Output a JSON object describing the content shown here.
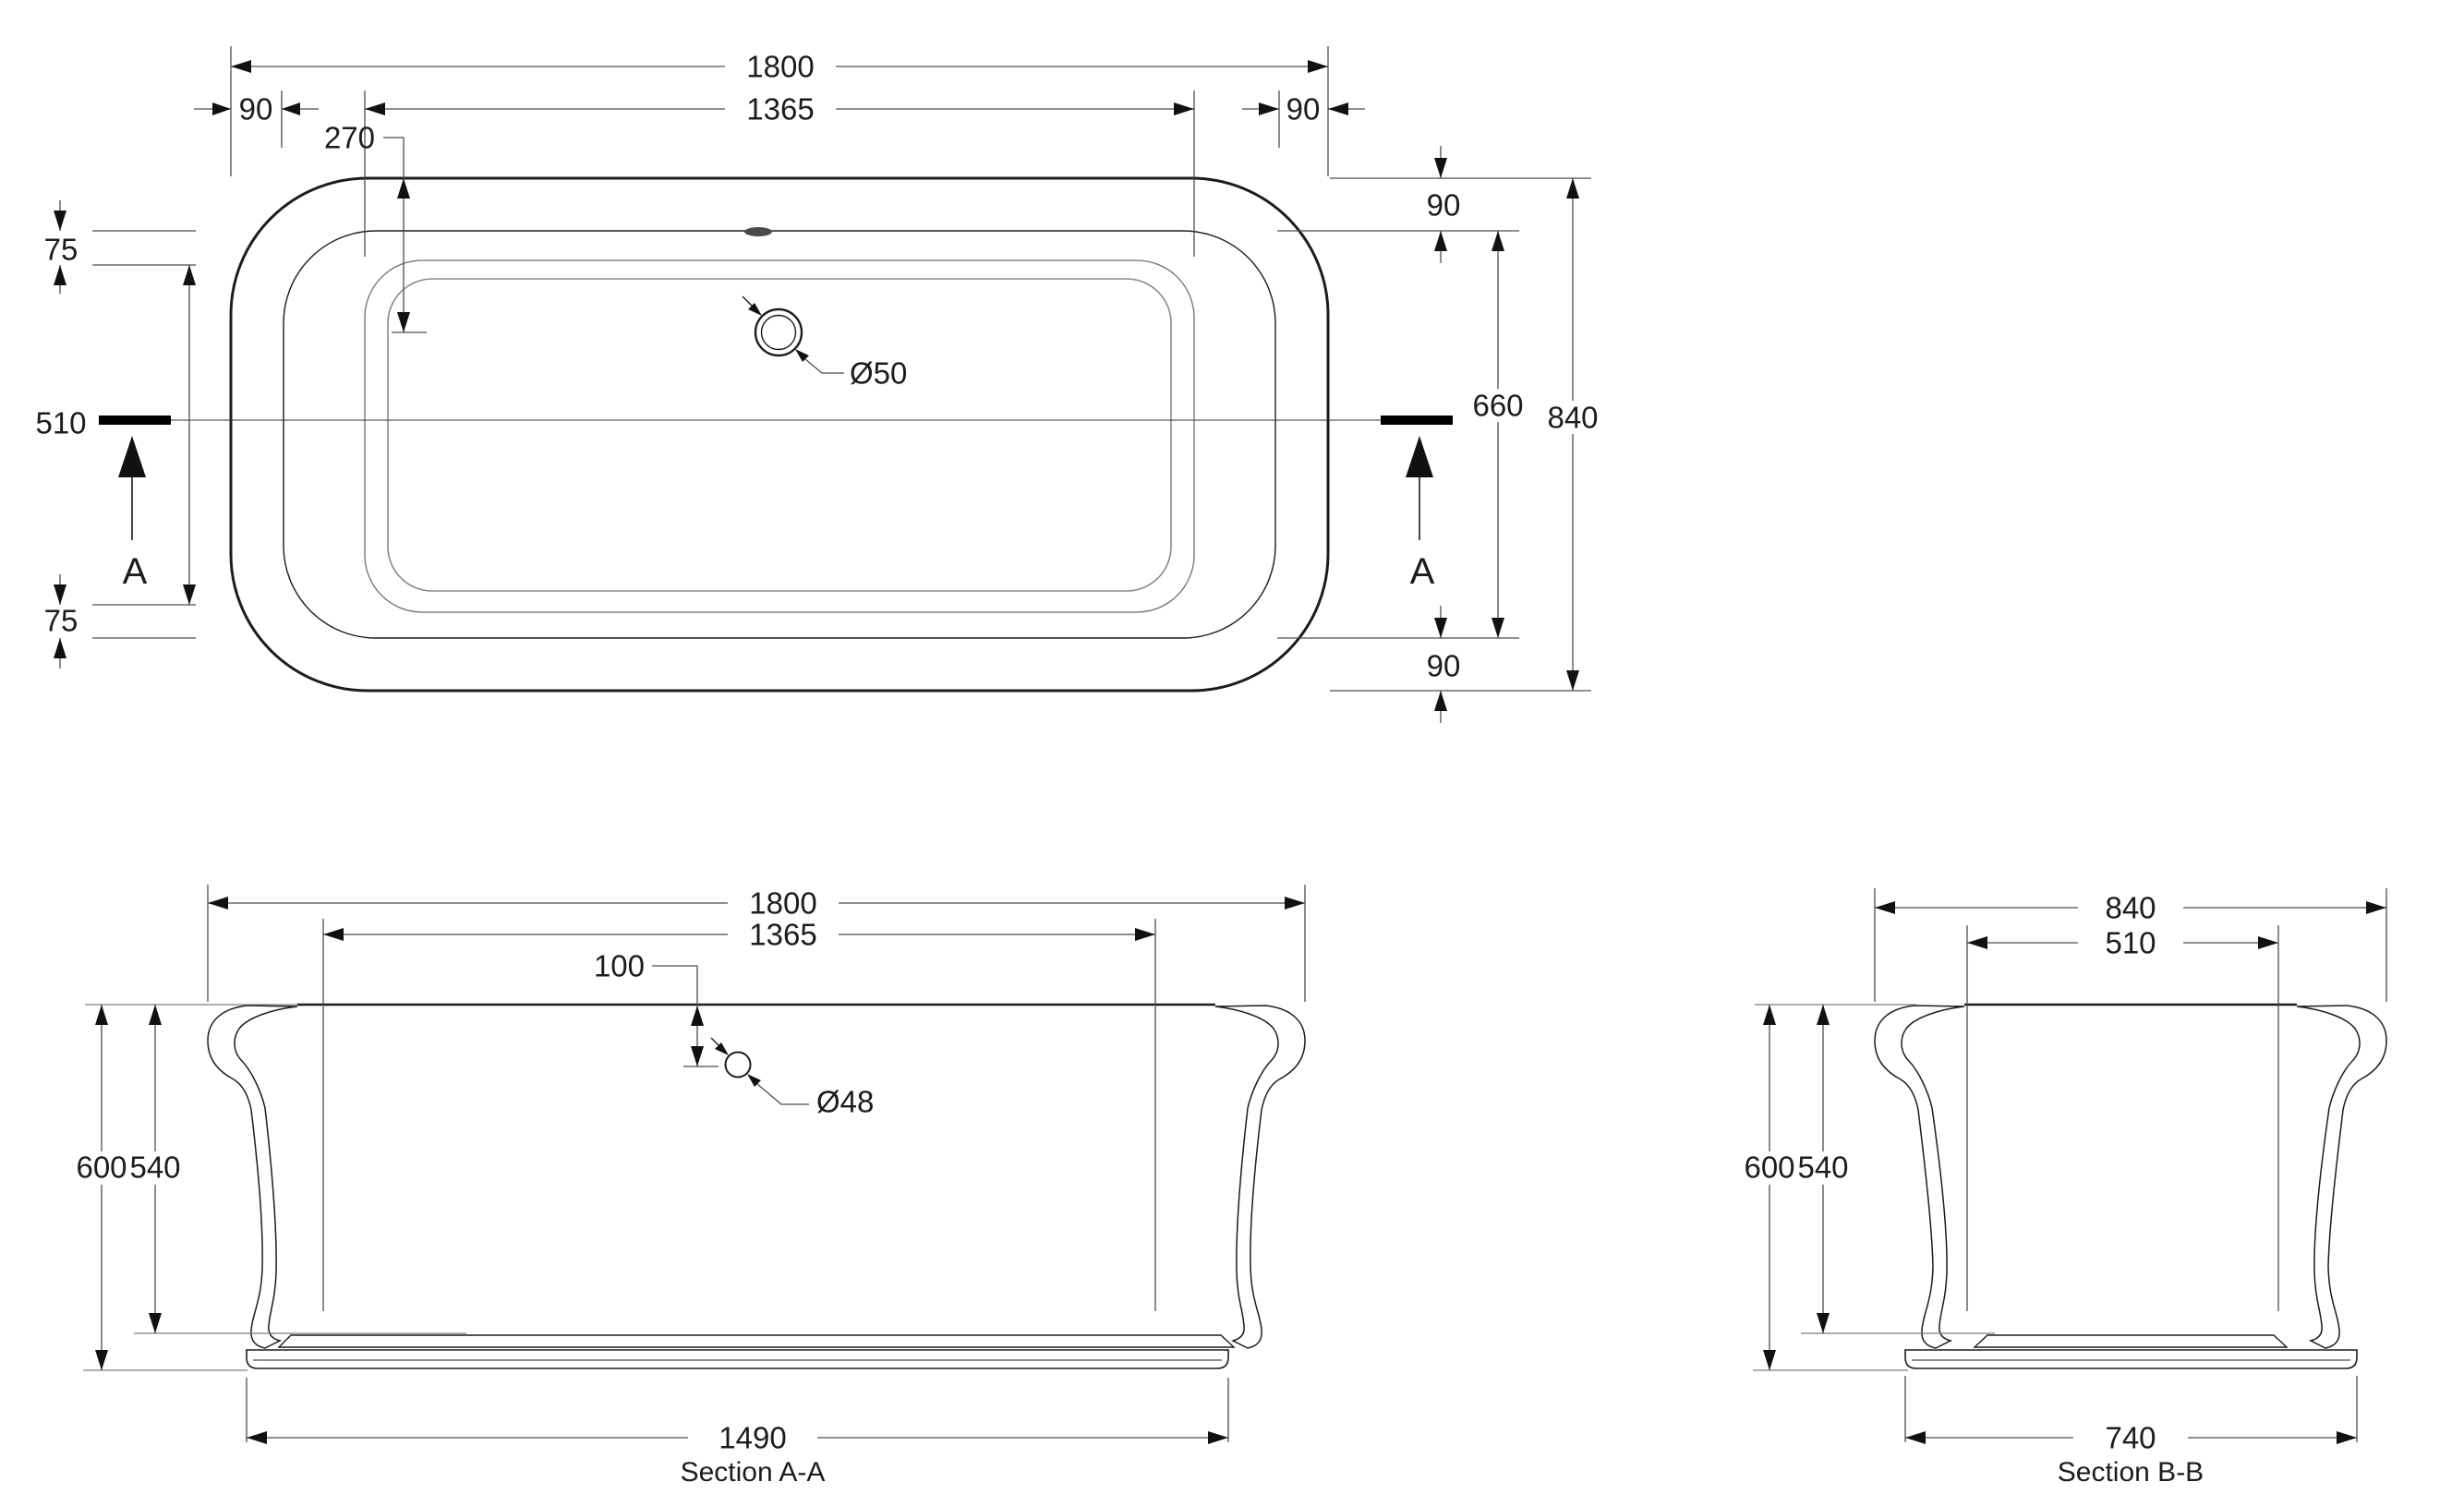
{
  "drawing": {
    "background": "#ffffff",
    "line_color": "#1c1c1c",
    "dim_color": "#4d4d4d"
  },
  "plan": {
    "dim_overall_length": "1800",
    "dim_rim_left": "90",
    "dim_inner_length": "1365",
    "dim_rim_right": "90",
    "dim_drain_offset": "270",
    "dim_rim_top_width": "75",
    "dim_section_width": "510",
    "dim_rim_bottom_width": "75",
    "dim_rim_top": "90",
    "dim_inner_width": "660",
    "dim_overall_width": "840",
    "dim_rim_bottom": "90",
    "dim_drain_diameter": "Ø50",
    "section_marker_left": "A",
    "section_marker_right": "A"
  },
  "section_aa": {
    "title": "Section A-A",
    "dim_overall_length": "1800",
    "dim_inner_length": "1365",
    "dim_drain_depth": "100",
    "dim_drain_diameter": "Ø48",
    "dim_overall_height": "600",
    "dim_inner_depth": "540",
    "dim_base_length": "1490"
  },
  "section_bb": {
    "title": "Section B-B",
    "dim_overall_width": "840",
    "dim_inner_width": "510",
    "dim_overall_height": "600",
    "dim_inner_depth": "540",
    "dim_base_width": "740"
  }
}
